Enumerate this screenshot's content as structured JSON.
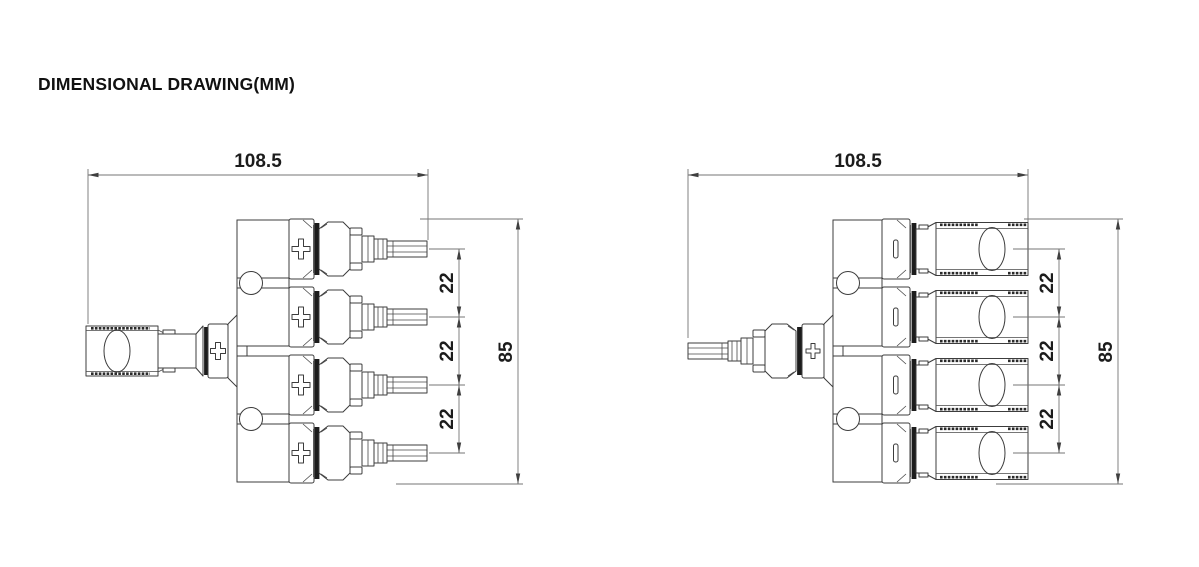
{
  "title": "DIMENSIONAL DRAWING(MM)",
  "drawings": {
    "left": {
      "width": "108.5",
      "height": "85",
      "pitch": [
        "22",
        "22",
        "22"
      ]
    },
    "right": {
      "width": "108.5",
      "height": "85",
      "pitch": [
        "22",
        "22",
        "22"
      ]
    }
  }
}
